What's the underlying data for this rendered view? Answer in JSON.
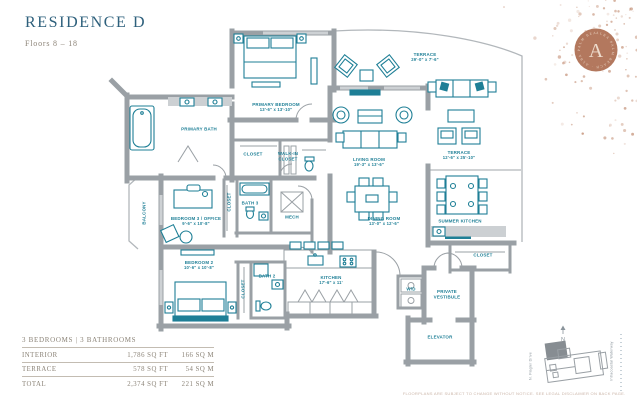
{
  "header": {
    "title": "RESIDENCE D",
    "subtitle": "Floors 8 – 18"
  },
  "badge": {
    "letter": "A",
    "ring_text": "ALBA PALM BEACH · ALBA PALM BEACH ·"
  },
  "floorplan": {
    "rooms": [
      {
        "label": "PRIMARY BEDROOM",
        "dims": "13'-6\" x 13'-10\"",
        "x": 276,
        "y": 108,
        "vertical": false
      },
      {
        "label": "PRIMARY BATH",
        "dims": "",
        "x": 199,
        "y": 130,
        "vertical": false
      },
      {
        "label": "CLOSET",
        "dims": "",
        "x": 253,
        "y": 155,
        "vertical": false
      },
      {
        "label": "WALK-IN\nCLOSET",
        "dims": "",
        "x": 288,
        "y": 157,
        "vertical": false
      },
      {
        "label": "TERRACE",
        "dims": "29'-0\" x 7'-6\"",
        "x": 425,
        "y": 58,
        "vertical": false
      },
      {
        "label": "LIVING ROOM",
        "dims": "19'-3\" x 13'-6\"",
        "x": 369,
        "y": 163,
        "vertical": false
      },
      {
        "label": "TERRACE",
        "dims": "12'-6\" x 25'-10\"",
        "x": 459,
        "y": 156,
        "vertical": false
      },
      {
        "label": "DINING ROOM",
        "dims": "13'-0\" x 12'-6\"",
        "x": 384,
        "y": 222,
        "vertical": false
      },
      {
        "label": "SUMMER KITCHEN",
        "dims": "",
        "x": 460,
        "y": 222,
        "vertical": false
      },
      {
        "label": "BEDROOM 3 / OFFICE",
        "dims": "9'-6\" x 10'-8\"",
        "x": 196,
        "y": 222,
        "vertical": false
      },
      {
        "label": "BATH 3",
        "dims": "",
        "x": 250,
        "y": 204,
        "vertical": false
      },
      {
        "label": "MECH",
        "dims": "",
        "x": 292,
        "y": 218,
        "vertical": false
      },
      {
        "label": "BALCONY",
        "dims": "",
        "x": 145,
        "y": 213,
        "vertical": true
      },
      {
        "label": "CLOSET",
        "dims": "",
        "x": 230,
        "y": 202,
        "vertical": true
      },
      {
        "label": "BEDROOM 2",
        "dims": "10'-6\" x 10'-8\"",
        "x": 199,
        "y": 266,
        "vertical": false
      },
      {
        "label": "CLOSET",
        "dims": "",
        "x": 244,
        "y": 289,
        "vertical": true
      },
      {
        "label": "BATH 2",
        "dims": "",
        "x": 267,
        "y": 277,
        "vertical": false
      },
      {
        "label": "KITCHEN",
        "dims": "17'-6\" x 11'",
        "x": 331,
        "y": 281,
        "vertical": false
      },
      {
        "label": "CLOSET",
        "dims": "",
        "x": 483,
        "y": 256,
        "vertical": false
      },
      {
        "label": "W/D",
        "dims": "",
        "x": 411,
        "y": 290,
        "vertical": false
      },
      {
        "label": "PRIVATE\nVESTIBULE",
        "dims": "",
        "x": 447,
        "y": 295,
        "vertical": false
      },
      {
        "label": "ELEVATOR",
        "dims": "",
        "x": 440,
        "y": 338,
        "vertical": false
      }
    ]
  },
  "area_table": {
    "header": "3 BEDROOMS | 3 BATHROOMS",
    "rows": [
      {
        "label": "INTERIOR",
        "sqft": "1,786 SQ FT",
        "sqm": "166 SQ M"
      },
      {
        "label": "TERRACE",
        "sqft": "578 SQ FT",
        "sqm": "54 SQ M"
      },
      {
        "label": "TOTAL",
        "sqft": "2,374 SQ FT",
        "sqm": "221 SQ M"
      }
    ]
  },
  "keyplan": {
    "north_label": "N",
    "street_label": "N. Flagler Drive",
    "water_label": "Intracoastal Waterway"
  },
  "disclaimer": "FLOORPLANS ARE SUBJECT TO CHANGE WITHOUT NOTICE. SEE LEGAL DISCLAIMER ON BACK PAGE.",
  "colors": {
    "accent_teal": "#1e7f96",
    "wall_gray": "#9aa0a5",
    "copper": "#b3785e",
    "title_blue": "#2e607c"
  }
}
